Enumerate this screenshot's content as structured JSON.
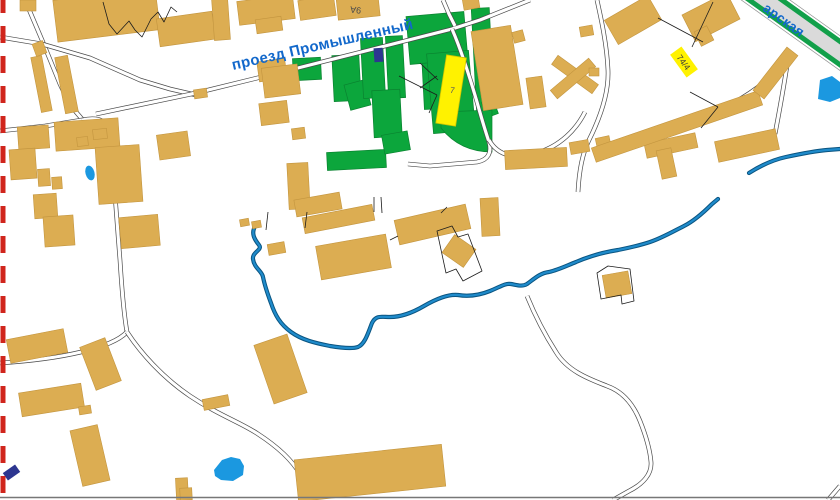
{
  "map": {
    "labels": {
      "street_main": "проезд Промышленный",
      "street_corner": "арская",
      "building_9a": "9А",
      "building_7": "7",
      "building_74_4": "74/4"
    },
    "colors": {
      "building": "#DCAD52",
      "building_stroke": "#C3953F",
      "green": "#0CA63C",
      "green_stroke": "#0A8330",
      "yellow": "#FFF200",
      "yellow_stroke": "#D4C500",
      "navy": "#2D3690",
      "river_outer": "#0A5480",
      "river_inner": "#1F8BCB",
      "pond": "#1B98E0",
      "road_casing": "#4A4A4A",
      "road_fill": "#FFFFFF",
      "highway_gray": "#DADADA",
      "highway_green": "#12A04A",
      "highway_edge": "#999999",
      "label_blue": "#1268CB",
      "label_dark": "#4A4A4A",
      "boundary_red": "#D0251C",
      "fence": "#1C1C1C",
      "bottom_line": "#777777"
    },
    "geometry": {
      "buildings": [
        [
          20,
          0,
          16,
          11,
          0
        ],
        [
          55,
          -6,
          103,
          42,
          -7
        ],
        [
          34,
          42,
          11,
          13,
          -20
        ],
        [
          36,
          56,
          11,
          56,
          -11
        ],
        [
          60,
          56,
          13,
          57,
          -11
        ],
        [
          158,
          15,
          56,
          28,
          -8
        ],
        [
          213,
          -2,
          16,
          42,
          -4
        ],
        [
          238,
          -2,
          56,
          24,
          -7
        ],
        [
          299,
          -2,
          36,
          20,
          -8
        ],
        [
          337,
          -6,
          42,
          24,
          -6
        ],
        [
          463,
          -3,
          16,
          12,
          -10
        ],
        [
          256,
          18,
          26,
          14,
          -8
        ],
        [
          258,
          60,
          28,
          20,
          -8
        ],
        [
          263,
          66,
          36,
          30,
          -7
        ],
        [
          260,
          102,
          28,
          22,
          -7
        ],
        [
          292,
          128,
          13,
          11,
          -7
        ],
        [
          194,
          89,
          13,
          9,
          -8
        ],
        [
          158,
          133,
          31,
          25,
          -8
        ],
        [
          18,
          126,
          31,
          23,
          -4
        ],
        [
          55,
          120,
          64,
          29,
          -4
        ],
        [
          97,
          146,
          44,
          57,
          -4
        ],
        [
          10,
          149,
          26,
          30,
          -4
        ],
        [
          38,
          169,
          12,
          17,
          -4
        ],
        [
          52,
          177,
          10,
          12,
          -4
        ],
        [
          34,
          194,
          23,
          24,
          -4
        ],
        [
          44,
          216,
          30,
          30,
          -4
        ],
        [
          120,
          216,
          39,
          31,
          -5
        ],
        [
          93,
          129,
          14,
          10,
          -6
        ],
        [
          77,
          137,
          11,
          9,
          -6
        ],
        [
          240,
          219,
          9,
          7,
          -10
        ],
        [
          252,
          221,
          9,
          7,
          -10
        ],
        [
          268,
          243,
          17,
          11,
          -10
        ],
        [
          288,
          163,
          21,
          46,
          -3
        ],
        [
          295,
          196,
          46,
          17,
          -10
        ],
        [
          303,
          211,
          71,
          16,
          -11
        ],
        [
          318,
          240,
          71,
          34,
          -10
        ],
        [
          396,
          212,
          73,
          25,
          -13
        ],
        [
          481,
          198,
          18,
          38,
          -3
        ],
        [
          477,
          28,
          40,
          80,
          -9
        ],
        [
          513,
          31,
          11,
          11,
          -15
        ],
        [
          528,
          77,
          16,
          31,
          -8
        ],
        [
          505,
          149,
          62,
          19,
          -3
        ],
        [
          570,
          141,
          19,
          12,
          -10
        ],
        [
          596,
          137,
          14,
          9,
          -12
        ],
        [
          645,
          138,
          52,
          15,
          -12
        ],
        [
          659,
          149,
          15,
          29,
          -12
        ],
        [
          716,
          135,
          62,
          21,
          -12
        ],
        [
          580,
          26,
          13,
          10,
          -10
        ],
        [
          550,
          69,
          50,
          11,
          36
        ],
        [
          548,
          73,
          50,
          11,
          -40
        ],
        [
          589,
          68,
          10,
          8,
          0
        ],
        [
          608,
          6,
          50,
          28,
          -30
        ],
        [
          686,
          2,
          50,
          30,
          -27
        ],
        [
          697,
          28,
          14,
          16,
          -27
        ],
        [
          589,
          119,
          176,
          15,
          -19
        ],
        [
          748,
          66,
          55,
          14,
          -52
        ],
        [
          8,
          334,
          58,
          24,
          -11
        ],
        [
          87,
          341,
          27,
          46,
          -21
        ],
        [
          20,
          388,
          63,
          24,
          -9
        ],
        [
          79,
          406,
          12,
          8,
          -9
        ],
        [
          203,
          397,
          26,
          11,
          -11
        ],
        [
          263,
          338,
          35,
          62,
          -19
        ],
        [
          76,
          427,
          28,
          57,
          -13
        ],
        [
          176,
          478,
          12,
          22,
          -3
        ],
        [
          296,
          452,
          148,
          42,
          -6
        ],
        [
          180,
          488,
          12,
          12,
          -3
        ],
        [
          446,
          240,
          26,
          22,
          35
        ],
        [
          604,
          273,
          26,
          23,
          -10
        ]
      ],
      "greens": [
        [
          293,
          58,
          28,
          22,
          -3
        ],
        [
          333,
          55,
          27,
          46,
          -3
        ],
        [
          347,
          82,
          21,
          26,
          -15
        ],
        [
          362,
          38,
          22,
          60,
          -3
        ],
        [
          387,
          36,
          17,
          62,
          -3
        ],
        [
          373,
          90,
          28,
          47,
          -3
        ],
        [
          327,
          151,
          59,
          18,
          -3
        ],
        [
          383,
          133,
          26,
          19,
          -10
        ],
        [
          423,
          55,
          21,
          54,
          -3
        ],
        [
          408,
          14,
          58,
          48,
          -5
        ],
        [
          430,
          52,
          42,
          80,
          -5
        ],
        [
          474,
          8,
          18,
          106,
          -3
        ],
        [
          484,
          100,
          12,
          16,
          -20
        ]
      ],
      "green_paths": [
        "M441,112 L492,110 L492,152 Q460,152 441,128 Z"
      ],
      "roads": [
        "M25,0 L42,40 L60,84 L70,105 L82,119",
        "M0,131 L45,126 L82,120",
        "M82,120 C100,116 108,122 110,132 C113,165 116,210 120,260 C122,292 124,315 127,332",
        "M127,332 C112,348 62,359 0,363",
        "M127,332 C140,352 162,377 190,396 C220,416 240,422 258,434 C278,447 292,460 300,474 C305,483 307,491 308,500",
        "M0,37 L42,44 L90,58 L140,80 L170,89 L196,95",
        "M96,114 L196,93 L290,70 L385,46 L452,29 L480,20 L530,0",
        "M452,29 C462,52 470,78 477,102 C482,120 486,133 489,142",
        "M489,142 C492,153 488,160 477,162 L430,166 L408,164",
        "M489,140 C498,156 516,160 537,153 C560,146 576,130 585,112",
        "M597,0 C601,18 607,45 608,70 C609,92 600,118 589,140 C582,154 579,172 578,192",
        "M789,52 C785,80 780,108 775,134",
        "M789,55 C774,76 754,92 733,103 L723,108",
        "M527,296 C536,318 547,338 556,352 C568,372 592,380 607,386 C624,392 634,406 640,421 C646,436 650,450 651,462 C652,474 643,484 629,491 L613,500",
        "M828,500 L840,486",
        "M443,0 L449,14 L455,26"
      ],
      "river": [
        "M256,225 C250,233 255,240 259,245 C263,250 252,252 253,259 C254,268 262,271 263,277 C265,287 268,295 271,303 C275,315 280,324 291,332 C302,340 315,343 330,346 C342,348 352,349 358,347 C365,344 368,333 372,323 C376,315 381,317 390,317 C400,317 412,313 424,306 C436,299 448,294 458,295 C470,297 480,295 490,291 C500,287 505,283 511,284 C517,285 522,287 527,284 C534,279 540,273 549,272 C558,270 566,266 576,262 C590,256 605,252 618,250 C628,248 638,246 650,242 C662,238 674,231 684,226 C694,221 704,212 712,204 L718,199",
        "M749,173 C760,166 772,160 786,157 C800,154 815,151 827,150 L840,149"
      ],
      "ponds": {
        "ellipse": {
          "cx": 90,
          "cy": 173,
          "rx": 4.5,
          "ry": 7.5,
          "rot": -15
        },
        "paths": [
          "M214,470 L222,460 L231,457 L240,459 L244,466 L243,475 L233,481 L221,480 L215,476 Z",
          "M818,99 L820,80 L832,76 L840,82 L840,98 L830,102 Z"
        ]
      },
      "navy": [
        [
          374,
          48,
          9,
          14,
          -4
        ],
        [
          4,
          468,
          15,
          9,
          -35
        ]
      ],
      "fences": [
        "M103,2 L109,24 L117,34 L129,21 L135,30 L142,37 L151,19 L158,12 L164,22 L171,7 L177,12",
        "M374,197 L374,212",
        "M381,197 L382,213",
        "M268,212 L266,230",
        "M307,212 L305,228",
        "M390,240 L398,236",
        "M441,213 L447,207",
        "M597,273 L608,266 L630,269 L634,301 L622,304 L621,295 L601,299 Z",
        "M437,231 L452,226 L458,237 L468,234 L482,271 L463,281 L456,269 L446,273 Z",
        "M399,76 L437,95",
        "M437,95 L429,113",
        "M658,18 L703,42",
        "M692,47 L713,2",
        "M690,92 L718,107",
        "M718,107 L701,128",
        "M420,63 L438,80",
        "M420,88 L437,76"
      ],
      "highway": {
        "x1": 746,
        "y1": -14,
        "x2": 858,
        "y2": 66
      },
      "yellow_building": {
        "tx": 451,
        "ty": 91,
        "rot": 9,
        "x": -10,
        "y": -35,
        "w": 20,
        "h": 69
      },
      "boundary": {
        "x": 3,
        "dash": "17 13",
        "width": 5
      },
      "bottom_line_y": 497.5
    }
  }
}
